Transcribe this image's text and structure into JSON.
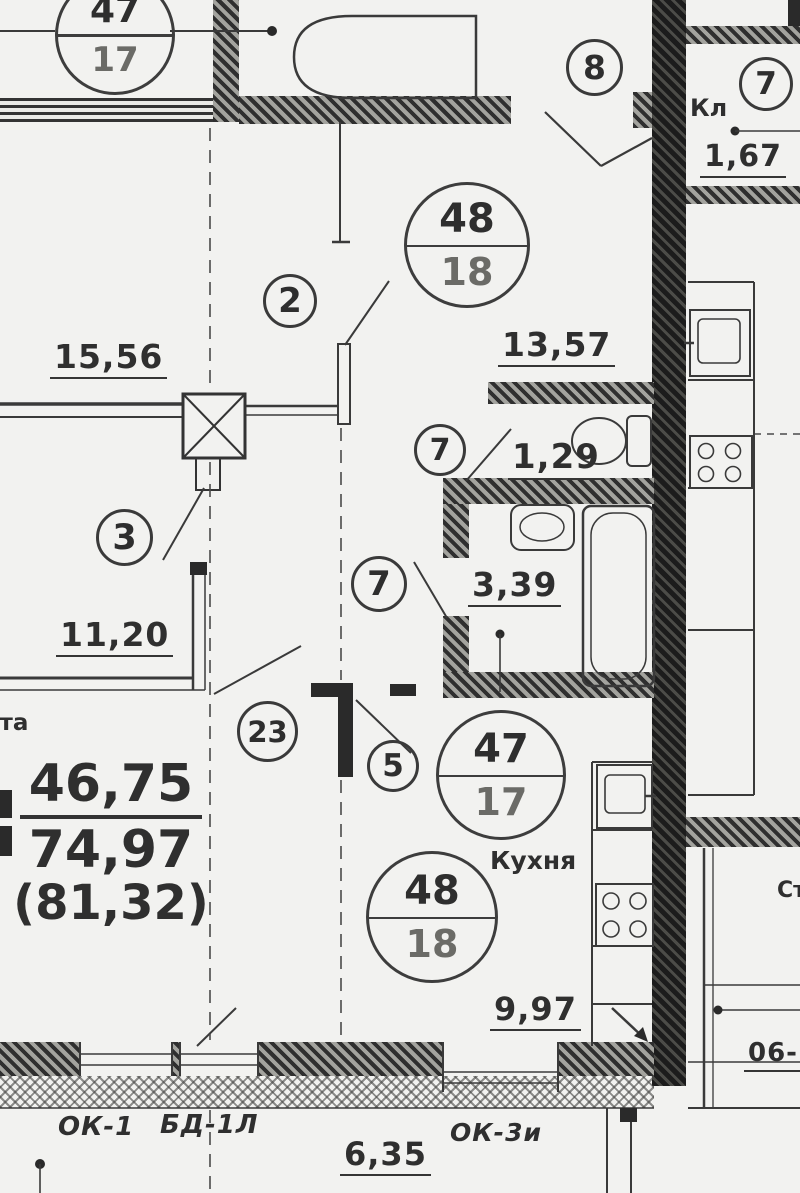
{
  "plan": {
    "palette": {
      "paper": "#f2f2f0",
      "ink": "#2f2f2f"
    },
    "summary": {
      "living_area": "46,75",
      "total_area": "74,97",
      "area_with_balcony": "(81,32)"
    },
    "areas": {
      "room_top": "15,56",
      "hall": "13,57",
      "wc": "1,29",
      "bathroom": "3,39",
      "room_left": "11,20",
      "closet": "1,67",
      "kitchen": "9,97"
    },
    "dimensions": {
      "bottom_width": "6,35",
      "right_edge_partial": "06-"
    },
    "stamps": {
      "apt47_top": {
        "num": "47",
        "den": "17"
      },
      "apt48_top": {
        "num": "48",
        "den": "18"
      },
      "apt47_kitchen": {
        "num": "47",
        "den": "17"
      },
      "apt48_kitchen": {
        "num": "48",
        "den": "18"
      }
    },
    "axis_marks": {
      "hall_door": "2",
      "room_door": "3",
      "kitchen_door": "5",
      "closet": "7",
      "wc_door": "7",
      "bath_door": "7",
      "entry_door": "8",
      "living_door": "23"
    },
    "labels": {
      "kitchen": "Кухня",
      "closet": "Кл",
      "room_fragment": "ата",
      "right_edge_fragment": "Ст"
    },
    "openings": {
      "window_1": "ОК-1",
      "balcony_door": "БД-1Л",
      "window_3": "ОК-3и"
    }
  }
}
